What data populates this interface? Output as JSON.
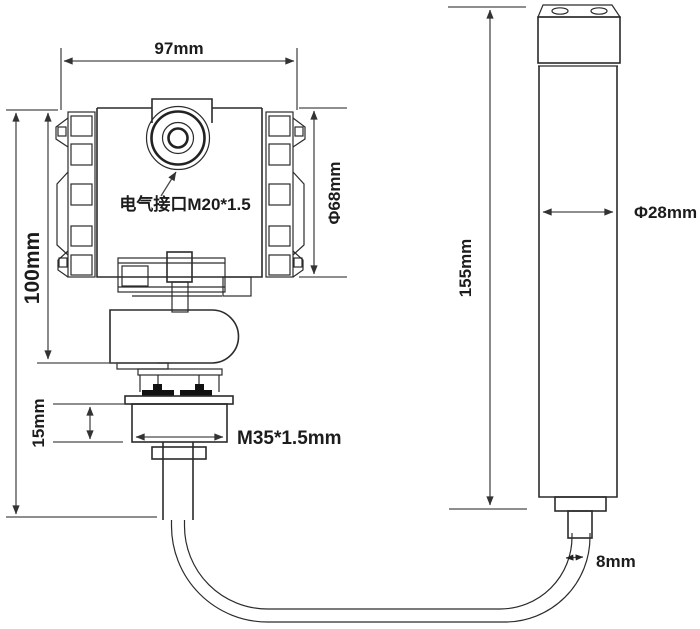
{
  "labels": {
    "top_width": "97mm",
    "housing_height": "100mm",
    "housing_diameter": "Φ68mm",
    "electrical_port": "电气接口M20*1.5",
    "nut_height": "15mm",
    "thread_spec": "M35*1.5mm",
    "probe_height": "155mm",
    "probe_diameter": "Φ28mm",
    "cable_diameter": "8mm"
  },
  "colors": {
    "line": "#2b2b2b",
    "dimension": "#4a4a4a",
    "text": "#1c1c1c",
    "background": "#ffffff"
  }
}
